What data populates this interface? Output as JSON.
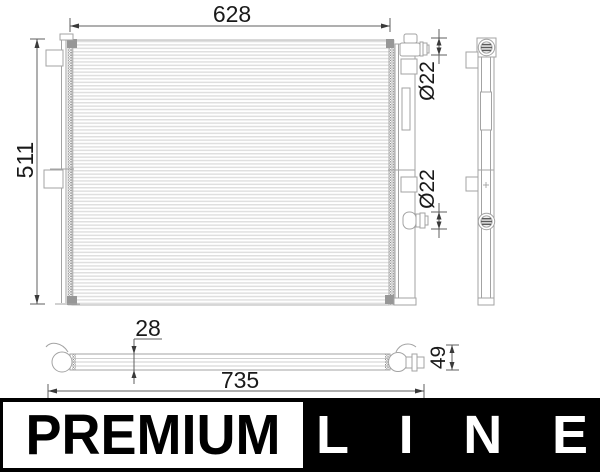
{
  "drawing": {
    "dimensions": {
      "front_width": "628",
      "front_height": "511",
      "port_top_diameter": "Ø22",
      "port_mid_diameter": "Ø22",
      "bottom_depth": "28",
      "bottom_overall_width": "735",
      "bottom_end_height": "49"
    },
    "colors": {
      "outline": "#9b9b9b",
      "fin_stripe": "#dfdfdf",
      "dimension_lines": "#555555",
      "dimension_text": "#1a1a1a",
      "background": "#ffffff"
    }
  },
  "banner": {
    "premium_label": "PREMIUM",
    "line_letters": [
      "L",
      "I",
      "N",
      "E"
    ],
    "colors": {
      "background": "#000000",
      "premium_box_background": "#ffffff",
      "premium_text": "#000000",
      "line_text": "#ffffff"
    }
  }
}
